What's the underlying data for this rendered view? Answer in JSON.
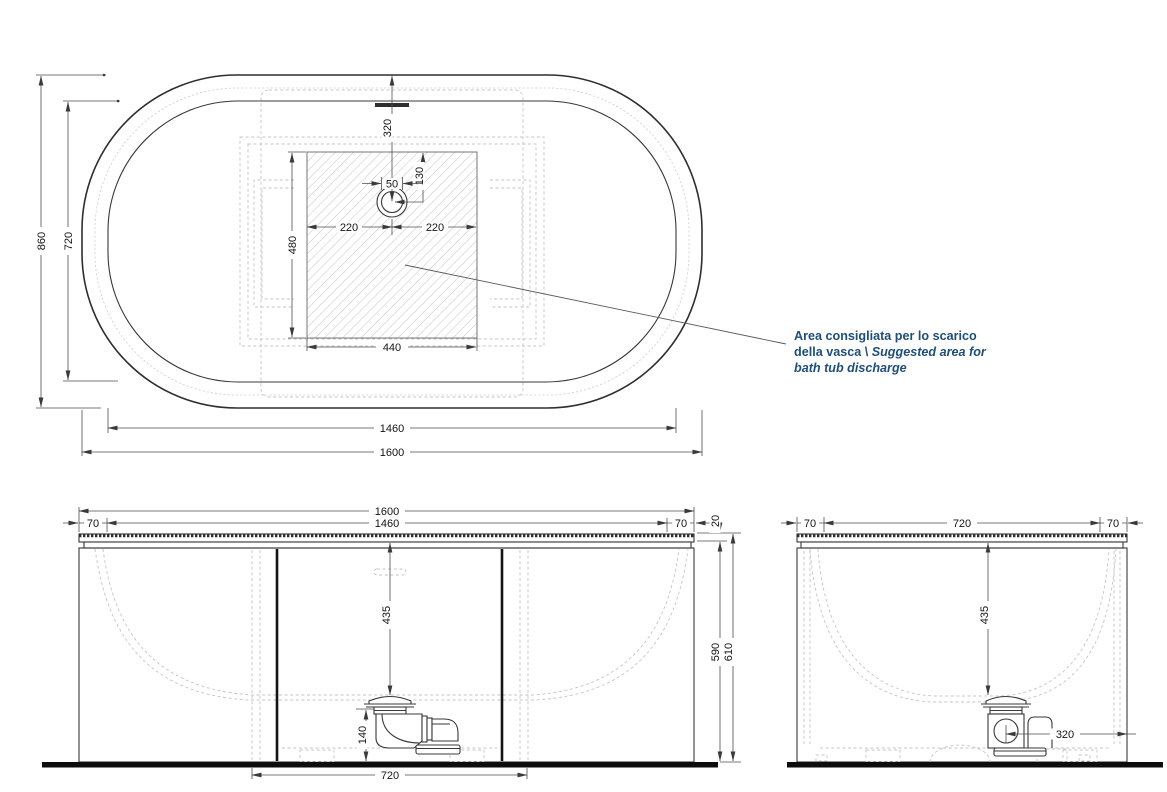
{
  "top_view": {
    "d860": "860",
    "d720": "720",
    "d1460": "1460",
    "d1600": "1600",
    "d440": "440",
    "d480": "480",
    "d220l": "220",
    "d220r": "220",
    "d320": "320",
    "d130": "130",
    "d50": "50"
  },
  "front_view": {
    "d1600": "1600",
    "d1460": "1460",
    "d70l": "70",
    "d70r": "70",
    "d20": "20",
    "d435": "435",
    "d140": "140",
    "d720": "720",
    "d590": "590",
    "d610": "610"
  },
  "side_view": {
    "d70l": "70",
    "d720": "720",
    "d70r": "70",
    "d435": "435",
    "d320": "320"
  },
  "note": {
    "l1": "Area consigliata per lo scarico",
    "l2a": "della vasca \\ ",
    "l2b": "Suggested area for",
    "l3": "bath tub discharge"
  },
  "colors": {
    "line": "#383838",
    "light_dash": "#c5c5c5",
    "dim_line": "#4d4d4d",
    "dim_text": "#141414",
    "annotation_text": "#1f4e79",
    "floor": "#0d0d0d",
    "hatch": "#b5b5b5"
  }
}
